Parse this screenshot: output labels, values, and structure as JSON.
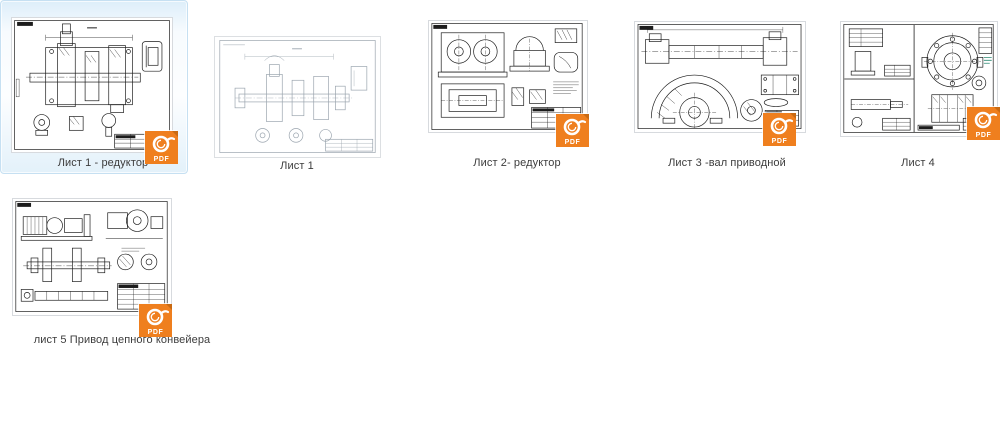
{
  "app": {
    "view": "thumbnail-grid",
    "background_color": "#ffffff"
  },
  "colors": {
    "selection_fill": "#e8f3fb",
    "selection_border": "#c6e0f2",
    "caption_text": "#3c3c3c",
    "pdf_badge_orange": "#ef7f1e",
    "pdf_badge_fold": "#c96a12",
    "drawing_ink": "#1c1c1c",
    "drawing_ink_light": "#9aa4ae",
    "annotation_teal": "#2e8b74"
  },
  "badge": {
    "label": "PDF",
    "icon": "foxit-pdf-icon"
  },
  "items": [
    {
      "caption": "Лист 1 - редуктор",
      "selected": true,
      "has_pdf_badge": true,
      "thumbnail_description": "assembly drawing of reducer, cross-section with detail views and title block"
    },
    {
      "caption": "Лист 1",
      "selected": false,
      "has_pdf_badge": false,
      "thumbnail_description": "light gray drawing of gear shaft assembly with detail views"
    },
    {
      "caption": "Лист 2- редуктор",
      "selected": false,
      "has_pdf_badge": true,
      "thumbnail_description": "reducer housing drawing with bore circles, top view and details"
    },
    {
      "caption": "Лист 3 -вал приводной",
      "selected": false,
      "has_pdf_badge": true,
      "thumbnail_description": "drive shaft drawing with large semicircular sprocket segment"
    },
    {
      "caption": "Лист 4",
      "selected": false,
      "has_pdf_badge": true,
      "thumbnail_description": "multi-panel sheet with bolt-circle flange and coupling section"
    },
    {
      "caption": "лист 5 Привод цепного конвейера",
      "selected": false,
      "has_pdf_badge": true,
      "thumbnail_description": "chain conveyor drive: motor, reducer, shaft and schematic"
    }
  ]
}
